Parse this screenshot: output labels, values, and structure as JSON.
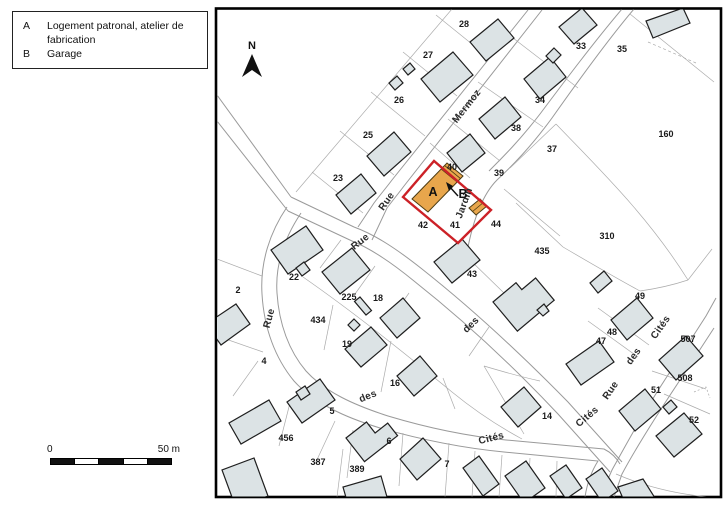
{
  "legend": {
    "items": [
      {
        "key": "A",
        "label": "Logement patronal, atelier de fabrication"
      },
      {
        "key": "B",
        "label": "Garage"
      }
    ]
  },
  "compass": {
    "label": "N"
  },
  "scale_bar": {
    "start": "0",
    "end": "50 m"
  },
  "map": {
    "colors": {
      "building_fill": "#dce3e5",
      "highlight_fill": "#e8a64c",
      "highlight_outline": "#cc2127"
    },
    "highlight_labels": [
      {
        "text": "A",
        "x": 433,
        "y": 196
      },
      {
        "text": "B",
        "x": 463,
        "y": 198
      }
    ],
    "parcel_labels": [
      {
        "text": "28",
        "x": 464,
        "y": 27
      },
      {
        "text": "27",
        "x": 428,
        "y": 58
      },
      {
        "text": "26",
        "x": 399,
        "y": 103
      },
      {
        "text": "25",
        "x": 368,
        "y": 138
      },
      {
        "text": "23",
        "x": 338,
        "y": 181
      },
      {
        "text": "33",
        "x": 581,
        "y": 49
      },
      {
        "text": "35",
        "x": 622,
        "y": 52
      },
      {
        "text": "34",
        "x": 540,
        "y": 103
      },
      {
        "text": "38",
        "x": 516,
        "y": 131
      },
      {
        "text": "37",
        "x": 552,
        "y": 152
      },
      {
        "text": "160",
        "x": 666,
        "y": 137
      },
      {
        "text": "40",
        "x": 452,
        "y": 170
      },
      {
        "text": "39",
        "x": 499,
        "y": 176
      },
      {
        "text": "42",
        "x": 423,
        "y": 228
      },
      {
        "text": "41",
        "x": 455,
        "y": 228
      },
      {
        "text": "44",
        "x": 496,
        "y": 227
      },
      {
        "text": "435",
        "x": 542,
        "y": 254
      },
      {
        "text": "310",
        "x": 607,
        "y": 239
      },
      {
        "text": "43",
        "x": 472,
        "y": 277
      },
      {
        "text": "22",
        "x": 294,
        "y": 280
      },
      {
        "text": "2",
        "x": 238,
        "y": 293
      },
      {
        "text": "225",
        "x": 349,
        "y": 300
      },
      {
        "text": "18",
        "x": 378,
        "y": 301
      },
      {
        "text": "434",
        "x": 318,
        "y": 323
      },
      {
        "text": "19",
        "x": 347,
        "y": 347
      },
      {
        "text": "4",
        "x": 264,
        "y": 364
      },
      {
        "text": "16",
        "x": 395,
        "y": 386
      },
      {
        "text": "5",
        "x": 332,
        "y": 414
      },
      {
        "text": "456",
        "x": 286,
        "y": 441
      },
      {
        "text": "387",
        "x": 318,
        "y": 465
      },
      {
        "text": "389",
        "x": 357,
        "y": 472
      },
      {
        "text": "6",
        "x": 389,
        "y": 444
      },
      {
        "text": "7",
        "x": 447,
        "y": 467
      },
      {
        "text": "14",
        "x": 547,
        "y": 419
      },
      {
        "text": "49",
        "x": 640,
        "y": 299
      },
      {
        "text": "48",
        "x": 612,
        "y": 335
      },
      {
        "text": "47",
        "x": 601,
        "y": 344
      },
      {
        "text": "507",
        "x": 688,
        "y": 342
      },
      {
        "text": "508",
        "x": 685,
        "y": 381
      },
      {
        "text": "51",
        "x": 656,
        "y": 393
      },
      {
        "text": "52",
        "x": 694,
        "y": 423
      }
    ],
    "street_labels": [
      {
        "text": "Mermoz",
        "x": 469,
        "y": 108,
        "angle": -52
      },
      {
        "text": "Rue",
        "x": 389,
        "y": 203,
        "angle": -55
      },
      {
        "text": "Rue",
        "x": 362,
        "y": 244,
        "angle": -38
      },
      {
        "text": "des",
        "x": 473,
        "y": 327,
        "angle": -44
      },
      {
        "text": "Cités",
        "x": 589,
        "y": 419,
        "angle": -40
      },
      {
        "text": "Rue",
        "x": 272,
        "y": 319,
        "angle": -75
      },
      {
        "text": "des",
        "x": 369,
        "y": 399,
        "angle": -22
      },
      {
        "text": "Cités",
        "x": 492,
        "y": 441,
        "angle": -14
      },
      {
        "text": "Rue",
        "x": 613,
        "y": 392,
        "angle": -55
      },
      {
        "text": "des",
        "x": 636,
        "y": 358,
        "angle": -55
      },
      {
        "text": "Cités",
        "x": 663,
        "y": 329,
        "angle": -55
      },
      {
        "text": "Jardin",
        "x": 467,
        "y": 204,
        "angle": -70
      }
    ]
  }
}
